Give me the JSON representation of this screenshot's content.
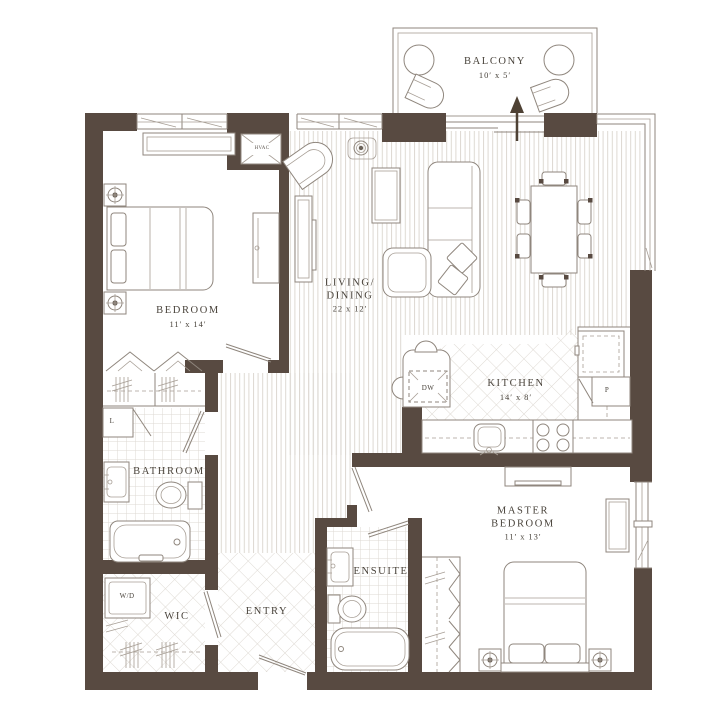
{
  "plan": {
    "type": "residential floor plan",
    "colors": {
      "wall": "#584a41",
      "line": "#8f867d",
      "text": "#4a443c",
      "floor_pattern": "#ddd8d2",
      "background": "#ffffff"
    },
    "rooms": {
      "balcony": {
        "name": "BALCONY",
        "dims": "10′ x 5′"
      },
      "bedroom": {
        "name": "BEDROOM",
        "dims": "11′ x 14′"
      },
      "living_dining": {
        "line1": "LIVING/",
        "line2": "DINING",
        "dims": "22 x 12′"
      },
      "kitchen": {
        "name": "KITCHEN",
        "dims": "14′ x 8′"
      },
      "bathroom": {
        "name": "BATHROOM"
      },
      "ensuite": {
        "name": "ENSUITE"
      },
      "master_bedroom": {
        "line1": "MASTER",
        "line2": "BEDROOM",
        "dims": "11′ x 13′"
      },
      "wic": {
        "name": "WIC"
      },
      "entry": {
        "name": "ENTRY"
      }
    },
    "fixtures": {
      "hvac": "HVAC",
      "dishwasher": "DW",
      "washer_dryer": "W/D",
      "linen": "L",
      "pantry": "P"
    }
  }
}
